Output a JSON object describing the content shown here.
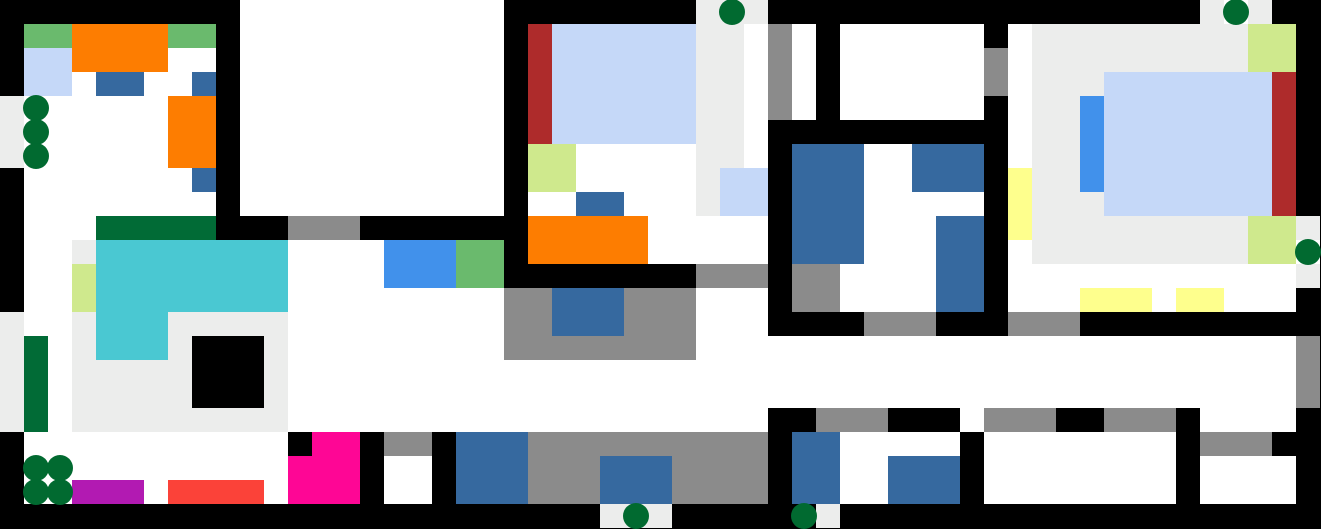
{
  "map": {
    "cols": 55,
    "rows": 22,
    "tile_size": 24,
    "background_color": "#000000",
    "tree_color": "#016a30",
    "tree_diameter": 26,
    "legend": {
      "K": {
        "name": "wall-black",
        "color": "#000000"
      },
      "W": {
        "name": "floor-white",
        "color": "#ffffff"
      },
      "E": {
        "name": "floor-light-gray",
        "color": "#ecedec"
      },
      "R": {
        "name": "gray-rug",
        "color": "#8b8b8b"
      },
      "g": {
        "name": "green-mat",
        "color": "#6aba6d"
      },
      "O": {
        "name": "orange-furniture",
        "color": "#fd7d01"
      },
      "L": {
        "name": "lavender-bed",
        "color": "#c5d8f8"
      },
      "B": {
        "name": "blue-furniture",
        "color": "#36699f"
      },
      "D": {
        "name": "darkgreen-counter",
        "color": "#016b36"
      },
      "C": {
        "name": "cyan-pool",
        "color": "#4ac8d2"
      },
      "Y": {
        "name": "palegreen-mat",
        "color": "#cfe98d"
      },
      "A": {
        "name": "azure-rug",
        "color": "#4191eb"
      },
      "M": {
        "name": "magenta-furniture",
        "color": "#fe0695"
      },
      "P": {
        "name": "purple-mat",
        "color": "#b21ab2"
      },
      "F": {
        "name": "red-mat",
        "color": "#fb4239"
      },
      "m": {
        "name": "maroon-strip",
        "color": "#ae2b2b"
      },
      "y": {
        "name": "yellow-mat",
        "color": "#feff8d"
      }
    },
    "grid": [
      "KKKKKKKKKKWWWWWWWWWWWKKKKKKKKEEEKKKKKKKKKKKKKKKKKKEWEKK",
      "KggOOOOggKWWWWWWWWWWWKmLLLLLLEEWRWKWWWWWWKWEEEEEEEEEYYK",
      "KLLOOOOWWKWWWWWWWWWWWKmLLLLLLEEWRWKWWWWWWRWEEEEEEEEEYYK",
      "KLLWBBWWBKWWWWWWWWWWWKmLLLLLLEEWRWKWWWWWWRWEEELLLLLLLmK",
      "EWWWWWWOOKWWWWWWWWWWWKmLLLLLLEEWRWKWWWWWWKWEEALLLLLLLmK",
      "EWWWWWWOOKWWWWWWWWWWWKmLLLLLLEEWKKKKKKKKKKWEEALLLLLLLmK",
      "EWWWWWWOOKWWWWWWWWWWWKYYWWWWWEEWKBBBWWBBBKWEEALLLLLLLmK",
      "KWWWWWWWBKWWWWWWWWWWWKYYWWWWWELLKBBBWWBBBKyEEALLLLLLLmK",
      "KWWWWWWWWKWWWWWWWWWWWKWWBBWWWELLKBBBWWWWWKyEEELLLLLLLmK",
      "KWWWDDDDDKKKRRRKKKKKKKOOOOOWWWWWKBBBWWWBBKyEEEEEEEEEYYE",
      "KWWECCCCCCCCWWWWAAAggKOOOOOWWWWWKBBBWWWBBKWEEEEEEEEEYYW",
      "KWWYCCCCCCCCWWWWAAAggKKKKKKKKRRRKRRWWWWBBKWWWWWWWWWWWWE",
      "KWWYCCCCCCCCWWWWWWWWWRRBBBRRRWWWKRRWWWWBBKWWWyyyWyyWWWK",
      "EWWECCCEEEEEWWWWWWWWWRRBBBRRRWWWKKKKRRRKKKRRRKKKKKKKKKK",
      "EDWECCCEKKKEWWWWWWWWWRRRRRRRRWWWWWWWWWWWWWWWWWWWWWWWWWR",
      "EDWEEEEEKKKEWWWWWWWWWWWWWWWWWWWWWWWWWWWWWWWWWWWWWWWWWWR",
      "EDWEEEEEKKKEWWWWWWWWWWWWWWWWWWWWWWWWWWWWWWWWWWWWWWWWWWR",
      "EDWEEEEEEEEEWWWWWWWWWWWWWWWWWWWWKKRRRKKKWRRRKKRRRKWWWWK",
      "KWWWWWWWWWWWKMMKRRKBBBRRRRRRRRRRKBBWWWWWKWWWWWWWWKRRRKK",
      "KWWWWWWWWWWWMMMKWWKBBBRRRBBBRRRRKBBWWBBBKWWWWWWWWKWWWWK",
      "KWWPPPWFFFFWMMMKWWKBBBRRRBBBRRRRKBBWWBBBKWWWWWWWWKWWWWK",
      "KKKKKKKKKKKKKKKKKKKKKKKKKEEEKKKKKKEKKKKKKKKKKKKKKKKKKKK"
    ],
    "trees": [
      {
        "col": 1,
        "row": 4
      },
      {
        "col": 1,
        "row": 5
      },
      {
        "col": 1,
        "row": 6
      },
      {
        "col": 30,
        "row": 0
      },
      {
        "col": 51,
        "row": 0
      },
      {
        "col": 54,
        "row": 10
      },
      {
        "col": 1,
        "row": 19
      },
      {
        "col": 2,
        "row": 19
      },
      {
        "col": 1,
        "row": 20
      },
      {
        "col": 2,
        "row": 20
      },
      {
        "col": 26,
        "row": 21
      },
      {
        "col": 33,
        "row": 21
      }
    ]
  }
}
